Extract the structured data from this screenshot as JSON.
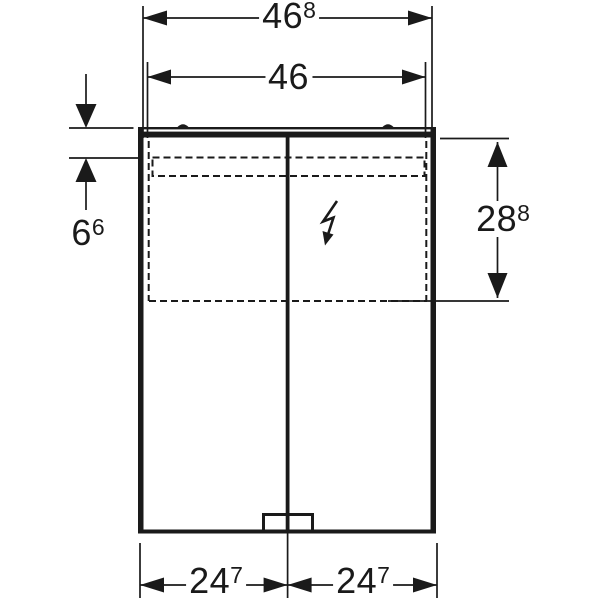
{
  "drawing": {
    "type": "technical-dimension-drawing",
    "subject": "double-door mirror cabinet, front view",
    "background_color": "#ffffff",
    "line_color": "#1a1a1a",
    "dimensions": {
      "overall_width": {
        "main": "46",
        "sup": "8"
      },
      "inner_width": {
        "main": "46",
        "sup": ""
      },
      "top_section_height": {
        "main": "6",
        "sup": "6"
      },
      "right_section_height": {
        "main": "28",
        "sup": "8"
      },
      "left_door_width": {
        "main": "24",
        "sup": "7"
      },
      "right_door_width": {
        "main": "24",
        "sup": "7"
      }
    },
    "icons": {
      "electrical": "lightning-bolt-icon"
    }
  }
}
